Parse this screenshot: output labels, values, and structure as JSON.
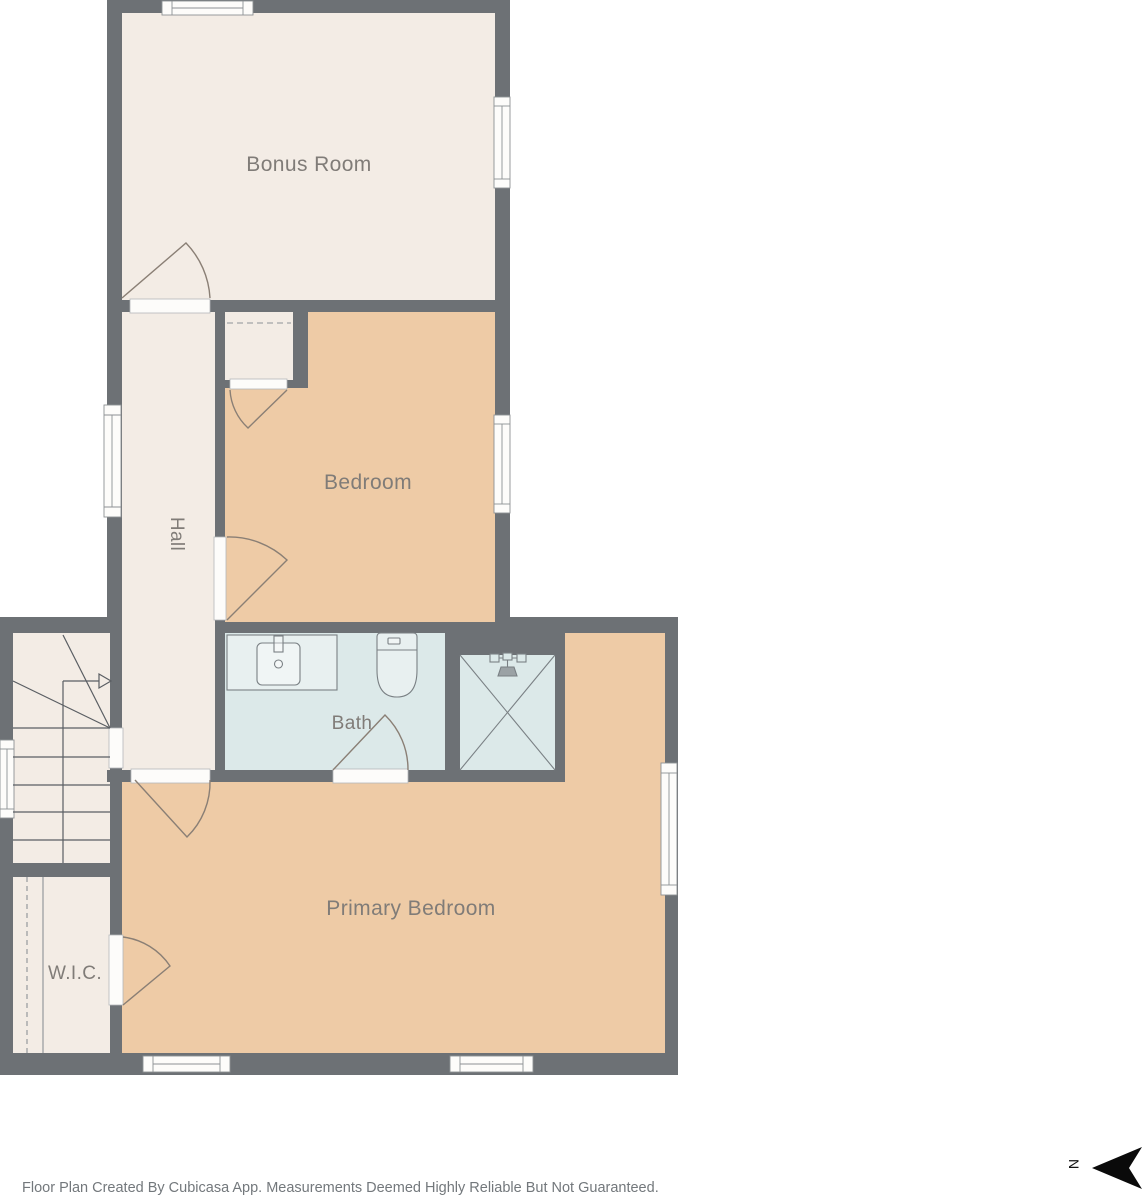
{
  "page": {
    "background": "#ffffff"
  },
  "rooms": [
    {
      "id": "bonus-room",
      "label": "Bonus Room",
      "floor_color": "#f3ece5"
    },
    {
      "id": "bedroom",
      "label": "Bedroom",
      "floor_color": "#eecba6"
    },
    {
      "id": "hall",
      "label": "Hall",
      "floor_color": "#f3ece5"
    },
    {
      "id": "bath",
      "label": "Bath",
      "floor_color": "#dce9e9"
    },
    {
      "id": "primary-bedroom",
      "label": "Primary Bedroom",
      "floor_color": "#eecba6"
    },
    {
      "id": "wic",
      "label": "W.I.C.",
      "floor_color": "#f3ece5"
    }
  ],
  "compass": {
    "north_label": "N"
  },
  "footer": {
    "disclaimer": "Floor Plan Created By Cubicasa App. Measurements Deemed Highly Reliable But Not Guaranteed."
  },
  "palette": {
    "wall": "#6d7175",
    "floor_cream": "#f3ece5",
    "floor_tan": "#eecba6",
    "floor_bath": "#dce9e9",
    "opening_white": "#fdfcfa",
    "door_line": "#8a7f75",
    "stair_line": "#5a5e63",
    "fixture_line": "#7a8084",
    "label_text": "#807c78",
    "north_arrow": "#0a0a0a"
  },
  "icons": [
    "vanity-sink-icon",
    "toilet-icon",
    "shower-icon",
    "staircase-icon",
    "north-arrow-icon",
    "window-icon",
    "door-swing-icon"
  ]
}
